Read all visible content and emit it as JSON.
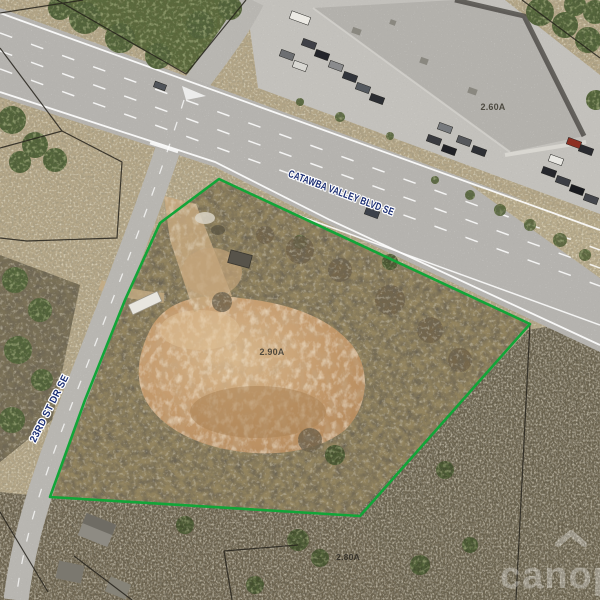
{
  "labels": {
    "street_main": "CATAWBA VALLEY BLVD SE",
    "street_side": "23RD ST DR SE",
    "acreage_main": "2.90A",
    "acreage_north": "2.60A",
    "acreage_south": "2.80A"
  },
  "watermark": {
    "text": "canopy"
  },
  "colors": {
    "parcel_boundary": "#12a538",
    "street_label": "#1b2e73",
    "acreage_label": "#3f3c33",
    "acreage_label_faint": "#2e2b24",
    "watermark_fill": "rgba(255,255,255,0.30)",
    "road": "#b5b3af",
    "parking": "#c3c1bc",
    "dirt": "#c49a6c",
    "parcel_line": "#26231c"
  }
}
